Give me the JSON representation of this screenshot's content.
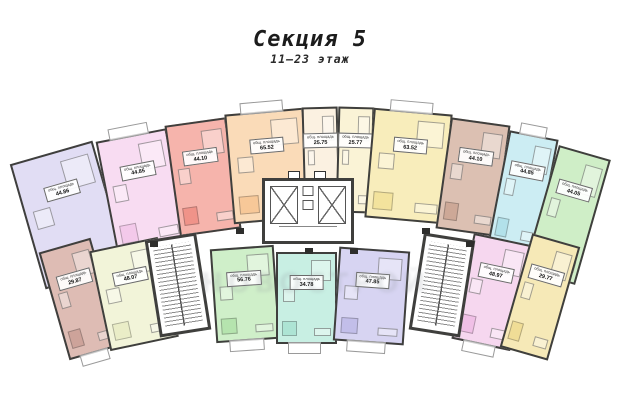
{
  "header": {
    "title": "Секция 5",
    "subtitle": "11–23 этаж"
  },
  "watermark": {
    "text": "НОВОСТРОЙ"
  },
  "labels": {
    "area_caption": "общ. площадь"
  },
  "colors": {
    "wall": "#3f3f3d",
    "background": "#ffffff"
  },
  "core": {
    "elevator_count": 4
  },
  "apartments": [
    {
      "id": "t1",
      "row": "top",
      "area": "44.86",
      "color": "#c9c3ec",
      "light": "#e1ddf4"
    },
    {
      "id": "t2",
      "row": "top",
      "area": "44.85",
      "color": "#f2c3e8",
      "light": "#f8dcf2"
    },
    {
      "id": "t3",
      "row": "top",
      "area": "44.10",
      "color": "#ef887e",
      "light": "#f6b4ac"
    },
    {
      "id": "t4",
      "row": "top",
      "area": "65.52",
      "color": "#f6c28e",
      "light": "#fadbb8"
    },
    {
      "id": "t5",
      "row": "top",
      "area": "25.75",
      "color": "#f7e7cf",
      "light": "#fbf1e1"
    },
    {
      "id": "t6",
      "row": "top",
      "area": "25.77",
      "color": "#f6ecbc",
      "light": "#faf3d6"
    },
    {
      "id": "t7",
      "row": "top",
      "area": "63.52",
      "color": "#f2e093",
      "light": "#f8edbb"
    },
    {
      "id": "t8",
      "row": "top",
      "area": "44.10",
      "color": "#c8a08e",
      "light": "#dcc0b2"
    },
    {
      "id": "t9",
      "row": "top",
      "area": "44.85",
      "color": "#aadee8",
      "light": "#ccedf3"
    },
    {
      "id": "t10",
      "row": "top",
      "area": "44.05",
      "color": "#addea4",
      "light": "#cfeec7"
    },
    {
      "id": "b1",
      "row": "bottom",
      "area": "29.87",
      "color": "#c89b92",
      "light": "#debcb4"
    },
    {
      "id": "b2",
      "row": "bottom",
      "area": "48.07",
      "color": "#e8ebc2",
      "light": "#f2f4d9"
    },
    {
      "id": "b3",
      "row": "bottom",
      "area": "56.76",
      "color": "#ade1a5",
      "light": "#cfefc9"
    },
    {
      "id": "b4",
      "row": "bottom",
      "area": "34.78",
      "color": "#a4e1cf",
      "light": "#c8efe3"
    },
    {
      "id": "b5",
      "row": "bottom",
      "area": "47.85",
      "color": "#bbb7e7",
      "light": "#d7d4f2"
    },
    {
      "id": "b6",
      "row": "bottom",
      "area": "48.97",
      "color": "#efb8e3",
      "light": "#f6d7ef"
    },
    {
      "id": "b7",
      "row": "bottom",
      "area": "29.77",
      "color": "#efd98b",
      "light": "#f6e9b7"
    }
  ],
  "stairs": [
    {
      "id": "stair-left"
    },
    {
      "id": "stair-right"
    }
  ]
}
